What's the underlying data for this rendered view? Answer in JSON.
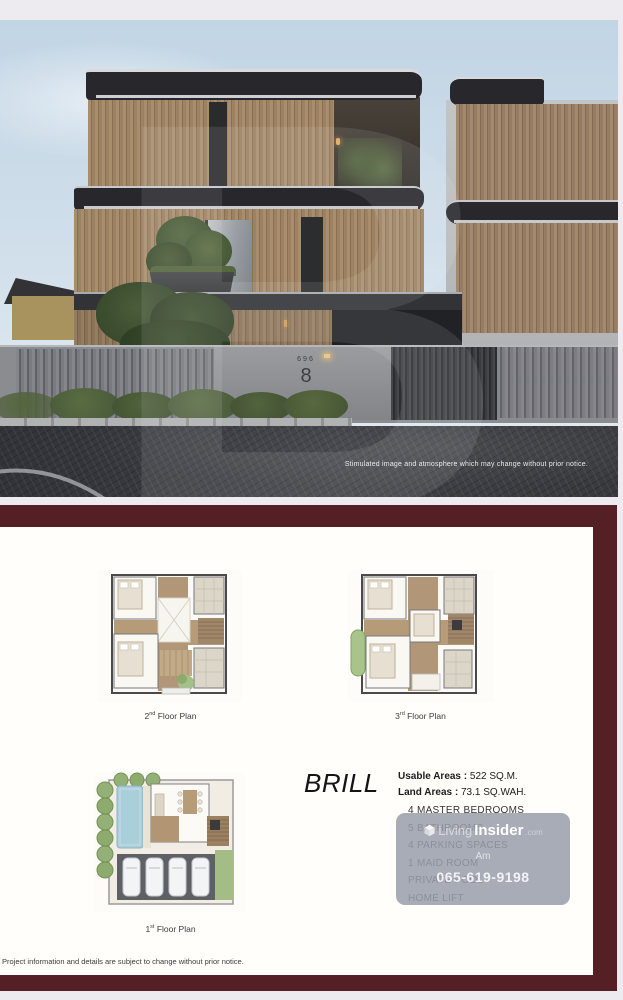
{
  "colors": {
    "accent_maroon": "#551F26",
    "card": "#FFFEFB",
    "page": "#EDEAF0"
  },
  "photo": {
    "caption": "Stimulated image and atmosphere which may change without prior notice.",
    "house_number_small": "696",
    "house_number_big": "8",
    "watermark_letter": "B"
  },
  "floor_plans": [
    {
      "num": "2",
      "sup": "nd",
      "text": " Floor Plan"
    },
    {
      "num": "3",
      "sup": "rd",
      "text": " Floor Plan"
    },
    {
      "num": "1",
      "sup": "st",
      "text": " Floor Plan"
    }
  ],
  "brand": {
    "name": "BRILL"
  },
  "specs": {
    "sep": " : ",
    "usable_label": "Usable Areas",
    "usable_value": "522 SQ.M.",
    "land_label": "Land Areas",
    "land_value": "73.1 SQ.WAH.",
    "features": [
      "4 MASTER BEDROOMS",
      "5 BATHROOMS",
      "4 PARKING SPACES",
      "1  MAID ROOM",
      "PRIVATE POOL",
      "HOME LIFT"
    ]
  },
  "watermark": {
    "brand_living": "Living",
    "brand_insider": "Insider",
    "brand_tld": ".com",
    "agent": "Am",
    "phone": "065-619-9198"
  },
  "footer": {
    "disclaimer": "Project information and details are subject to change without prior notice."
  }
}
